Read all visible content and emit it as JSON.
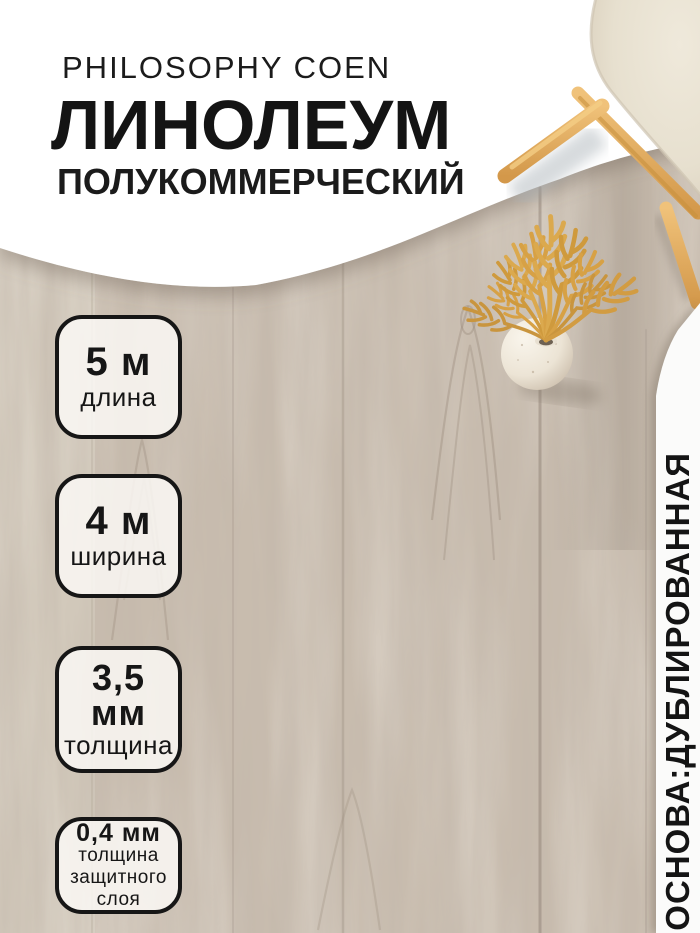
{
  "header": {
    "brand": "PHILOSOPHY COEN",
    "title": "ЛИНОЛЕУМ",
    "subtitle": "ПОЛУКОММЕРЧЕСКИЙ"
  },
  "badges": [
    {
      "value": "5 м",
      "label": "длина"
    },
    {
      "value": "4 м",
      "label": "ширина"
    },
    {
      "value": "3,5 мм",
      "label": "толщина"
    },
    {
      "value": "0,4 мм",
      "label": "толщина\nзащитного\nслоя"
    }
  ],
  "side_note": "ОСНОВА:ДУБЛИРОВАННАЯ",
  "colors": {
    "text": "#161616",
    "badge_border": "#161616",
    "badge_background": "rgba(251,249,245,0.84)",
    "background_white": "#ffffff",
    "wood_base": "#c8bcae",
    "wheat_gold": "#d7a145",
    "chair_wood": "#e5b269",
    "chair_seat": "#e9e2d3",
    "vase_ivory": "#ece4d5"
  }
}
